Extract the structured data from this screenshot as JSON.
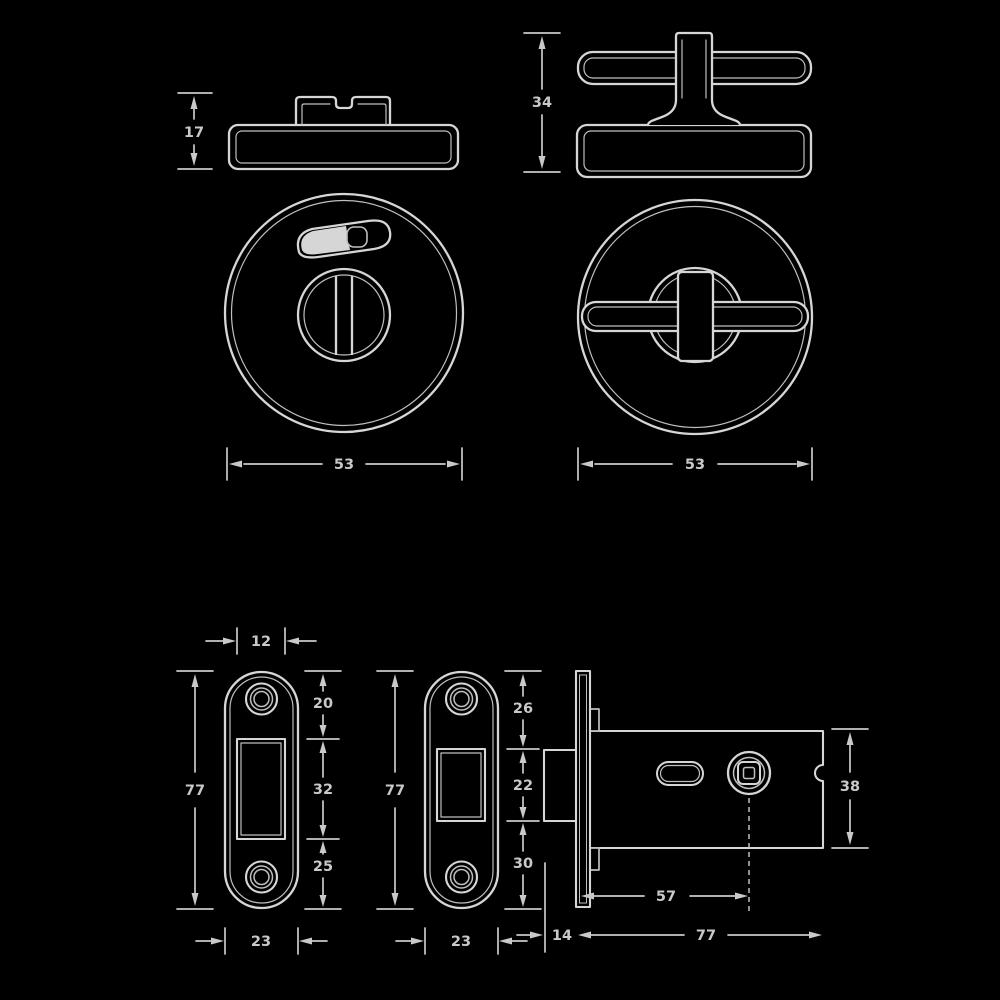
{
  "page": {
    "background_color": "#000000",
    "line_color": "#d6d6d6",
    "text_color": "#c9c9c9",
    "description": "Technical line drawing of bathroom turn-and-release door hardware with mortice bolt, white lines on black"
  },
  "dims": {
    "indicator_profile_height": "17",
    "turn_profile_height": "34",
    "indicator_rose_diameter": "53",
    "turn_rose_diameter": "53",
    "strike_slot_width": "12",
    "strike_plate_length": "77",
    "strike_top_offset": "20",
    "strike_slot_height": "32",
    "strike_bottom_offset": "25",
    "strike_plate_width": "23",
    "forend_plate_length": "77",
    "forend_top_offset": "26",
    "forend_slot_height": "22",
    "forend_bottom_offset": "30",
    "forend_plate_width": "23",
    "lock_case_height": "38",
    "lock_backset": "57",
    "lock_case_depth": "77",
    "lock_faceplate_width": "14"
  }
}
